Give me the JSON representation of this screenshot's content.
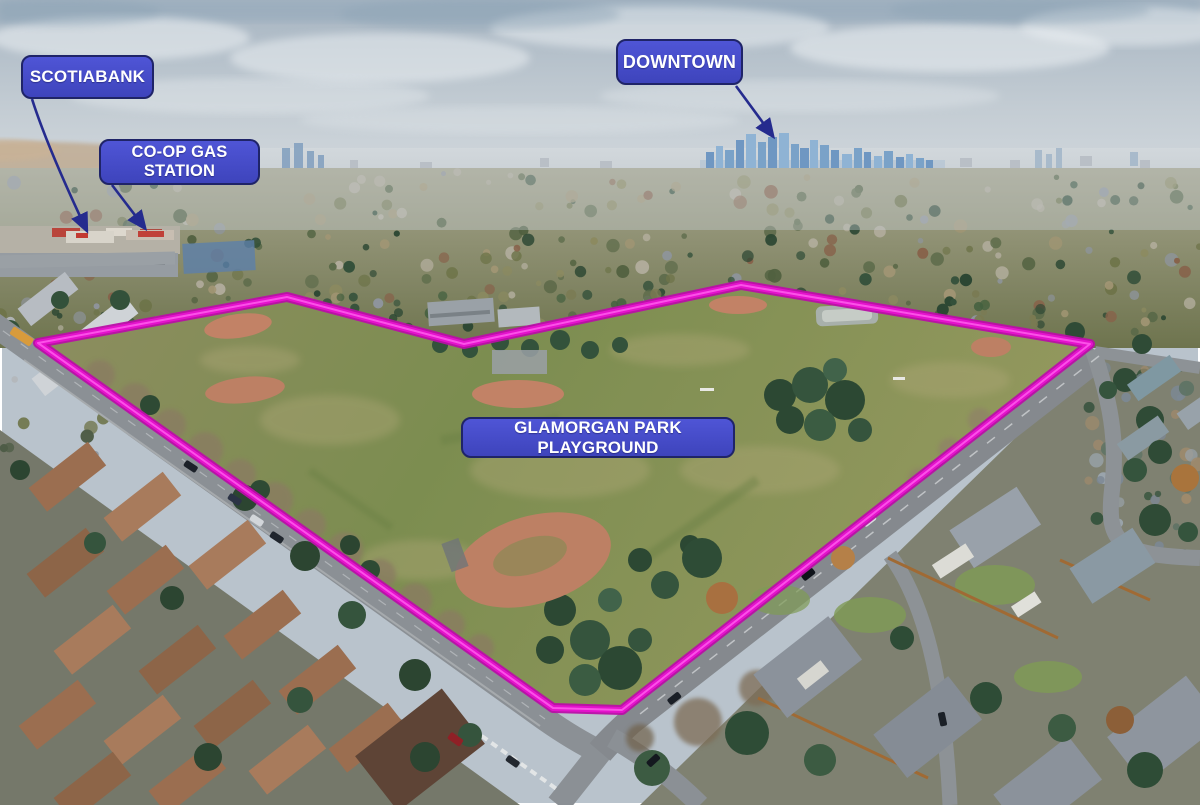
{
  "labels": {
    "scotiabank": {
      "text": "SCOTIABANK"
    },
    "coop": {
      "text": "CO-OP GAS STATION"
    },
    "downtown": {
      "text": "DOWNTOWN"
    },
    "park": {
      "text": "GLAMORGAN PARK PLAYGROUND"
    }
  },
  "colors": {
    "label_fill": "#4f55d6",
    "label_border": "#1f2468",
    "label_text": "#ffffff",
    "boundary_outline": "#e412cc",
    "arrow": "#252b8e"
  }
}
